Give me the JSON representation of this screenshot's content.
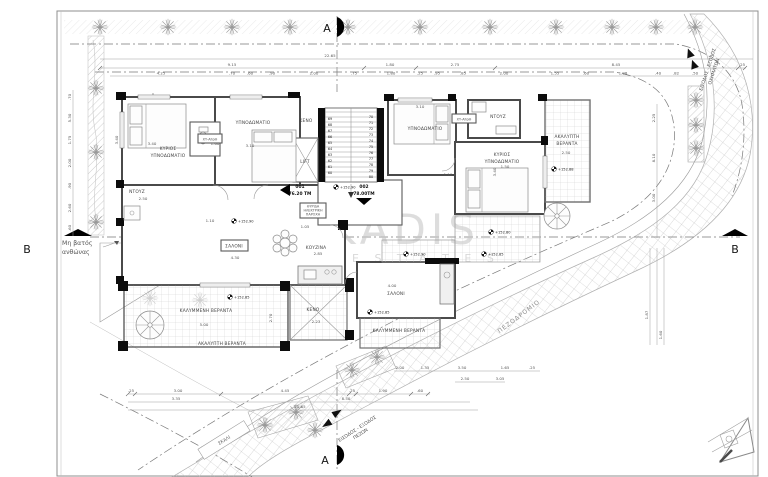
{
  "watermark": {
    "brand": "KADIS",
    "sub": "E S T A T E S"
  },
  "section_markers": {
    "a": "A",
    "b": "B"
  },
  "site_labels": {
    "flowerbed_line1": "Μη βατός",
    "flowerbed_line2": "ανθώνας",
    "sidewalk": "ΠΕΖΟΔΡΟΜΙΟ",
    "pedestrian_line1": "ΕΙΣΟΔΟΣ - ΕΞΟΔΟΣ",
    "pedestrian_line2": "ΠΕΖΩΝ",
    "vehicle_line1": "ΕΙΣΟΔΟΣ - ΕΞΟΔΟΣ",
    "vehicle_line2": "ΟΧΗΜΑΤΩΝ",
    "steps": "ΣΚΑΛΙ"
  },
  "units": {
    "unit1_no": "001",
    "unit1_area": "76.20 ΤΜ",
    "unit2_no": "002",
    "unit2_area": "78.00ΤΜ"
  },
  "rooms": {
    "master_line1": "ΚΥΡΙΟΣ",
    "master_line2": "ΥΠΝΟΔΩΜΑΤΙΟ",
    "bedroom": "ΥΠΝΟΔΩΜΑΤΙΟ",
    "shower": "ΝΤΟΥΖ",
    "storage_tag": "ΧΥ-ΑποΘ",
    "living": "ΣΑΛΟΝΙ",
    "kitchen": "ΚΟΥΖΙΝΑ",
    "covered_veranda": "ΚΑΛΥΜΜΕΝΗ ΒΕΡΑΝΤΑ",
    "uncovered_veranda": "ΑΚΑΛΥΠΤΗ ΒΕΡΑΝΤΑ",
    "uncovered_line1": "ΑΚΑΛΥΠΤΗ",
    "uncovered_line2": "ΒΕΡΑΝΤΑ",
    "void": "ΚΕΝΟ",
    "lift": "LIFT",
    "meter_line1": "ΘΥΡΙΔΑ",
    "meter_line2": "ΗΛΕΚΤΡΙΚΗ",
    "meter_line3": "ΠΑΡΟΧΗ"
  },
  "levels": {
    "values": [
      "+152.90",
      "+152.90",
      "+152.88",
      "+152.85",
      "+152.90",
      "+152.85",
      "+152.85",
      "+152.80"
    ]
  },
  "stairs": {
    "left_steps": [
      "69",
      "68",
      "67",
      "66",
      "65",
      "64",
      "63",
      "62",
      "61",
      "60"
    ],
    "right_steps": [
      "70",
      "71",
      "72",
      "73",
      "74",
      "75",
      "76",
      "77",
      "78",
      "79",
      "80"
    ]
  },
  "dims": {
    "top_total": [
      "22.65"
    ],
    "top_main": [
      "9.15",
      "1.80",
      "2.75",
      "8.45",
      ".25"
    ],
    "top_small": [
      "4.25",
      ".70",
      ".60",
      ".90",
      "2.00",
      ".75",
      "1.80",
      ".25",
      ".95",
      ".85",
      "2.00",
      "1.55",
      ".60",
      "1.98",
      ".40",
      ".82",
      ".50"
    ],
    "left_chain": [
      ".70",
      "5.30",
      "1.75",
      "2.00",
      ".90",
      "2.60",
      ".60"
    ],
    "right_chain": [
      "2.25",
      "8.10",
      "3.00"
    ],
    "right_lower": [
      "1.87",
      "1.60"
    ],
    "bottom_row1": [
      ".25",
      "3.00",
      "4.45",
      ".25",
      "1.90",
      ".60"
    ],
    "bottom_row2": [
      "3.35",
      "8.50"
    ],
    "bottom_row3": [
      "21.65"
    ],
    "road_row1": [
      "2.00",
      "1.35",
      "3.50",
      "1.65",
      ".25"
    ],
    "road_row2": [
      "2.50",
      "3.05"
    ],
    "inner": [
      "3.40",
      "1.60",
      "3.10",
      "2.50",
      "1.10",
      "3.10",
      "1.10",
      "1.50",
      "2.50",
      "4.30",
      "2.85",
      "5.00",
      "2.23",
      "4.00",
      "1.05"
    ],
    "inner_rot": [
      "3.40",
      "3.40",
      "2.70"
    ]
  }
}
